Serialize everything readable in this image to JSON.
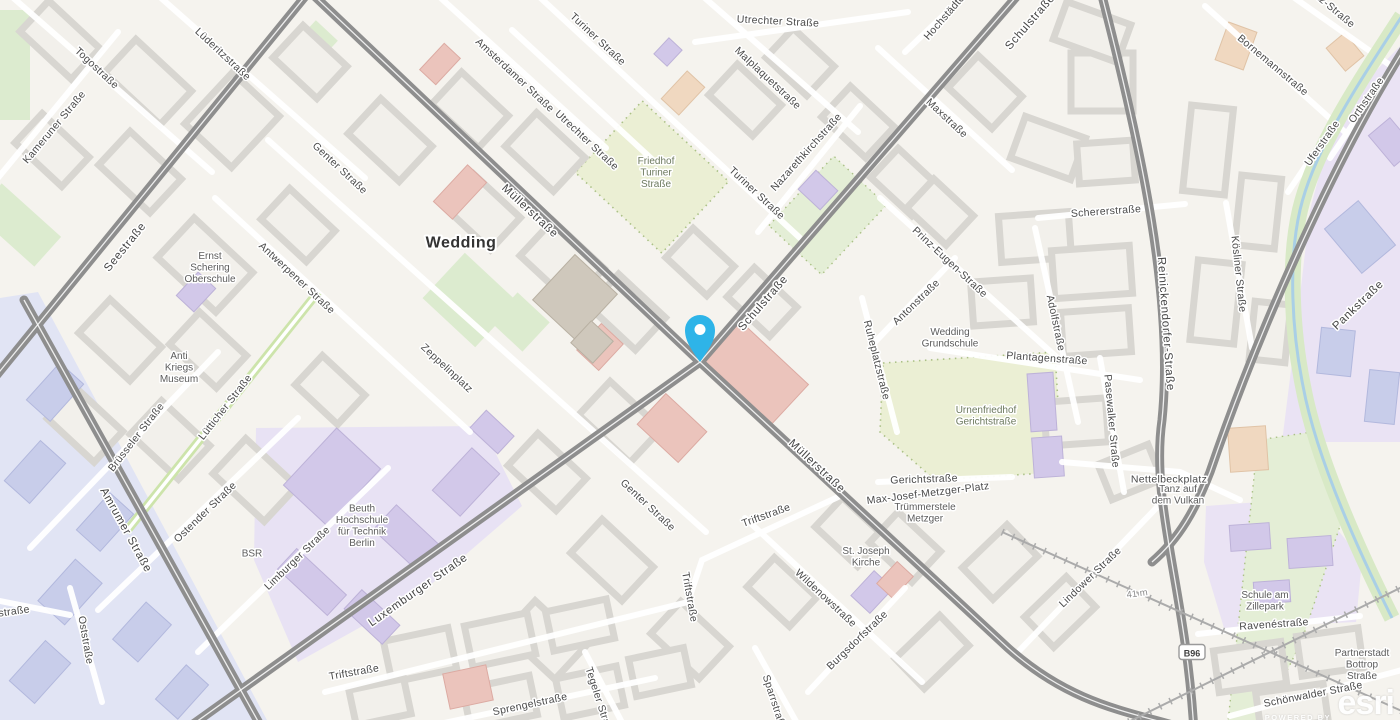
{
  "map": {
    "city_label": "Wedding",
    "labels": [
      {
        "t": "Togostraße",
        "x": 97,
        "y": 68,
        "r": 43,
        "c": "st"
      },
      {
        "t": "Kameruner Straße",
        "x": 54,
        "y": 127,
        "r": -50,
        "c": "st"
      },
      {
        "t": "Lüderitzstraße",
        "x": 223,
        "y": 54,
        "r": 43,
        "c": "st"
      },
      {
        "t": "Genter Straße",
        "x": 340,
        "y": 168,
        "r": 43,
        "c": "st"
      },
      {
        "t": "Genter Straße",
        "x": 648,
        "y": 505,
        "r": 43,
        "c": "st"
      },
      {
        "t": "Antwerpener Straße",
        "x": 297,
        "y": 278,
        "r": 43,
        "c": "st"
      },
      {
        "t": "Amsterdamer Straße",
        "x": 515,
        "y": 75,
        "r": 43,
        "c": "st"
      },
      {
        "t": "Turiner Straße",
        "x": 598,
        "y": 39,
        "r": 43,
        "c": "st"
      },
      {
        "t": "Turiner Straße",
        "x": 757,
        "y": 193,
        "r": 43,
        "c": "st"
      },
      {
        "t": "Utrechter Straße",
        "x": 587,
        "y": 140,
        "r": 43,
        "c": "st"
      },
      {
        "t": "Utrechter Straße",
        "x": 778,
        "y": 21,
        "r": 3,
        "c": "st"
      },
      {
        "t": "Malplaquetstraße",
        "x": 768,
        "y": 78,
        "r": 43,
        "c": "st"
      },
      {
        "t": "Nazarethkirchstraße",
        "x": 806,
        "y": 152,
        "r": -48,
        "c": "st"
      },
      {
        "t": "Hochstädter Str.",
        "x": 952,
        "y": 8,
        "r": -49,
        "c": "st"
      },
      {
        "t": "Maxstraße",
        "x": 947,
        "y": 118,
        "r": 43,
        "c": "st"
      },
      {
        "t": "Schulstraße",
        "x": 1030,
        "y": 22,
        "r": -49,
        "c": "stM"
      },
      {
        "t": "Schulstraße",
        "x": 763,
        "y": 303,
        "r": -49,
        "c": "stM"
      },
      {
        "t": "Müllerstraße",
        "x": 530,
        "y": 211,
        "r": 43,
        "c": "stM"
      },
      {
        "t": "Müllerstraße",
        "x": 817,
        "y": 466,
        "r": 43,
        "c": "stM"
      },
      {
        "t": "Seestraße",
        "x": 125,
        "y": 247,
        "r": -51,
        "c": "stM"
      },
      {
        "t": "Luxemburger Straße",
        "x": 418,
        "y": 590,
        "r": -35,
        "c": "stM"
      },
      {
        "t": "Amrumer Straße",
        "x": 126,
        "y": 530,
        "r": 61,
        "c": "stM"
      },
      {
        "t": "Brüsseler Straße",
        "x": 136,
        "y": 437,
        "r": -52,
        "c": "st"
      },
      {
        "t": "Lütticher Straße",
        "x": 225,
        "y": 407,
        "r": -52,
        "c": "st"
      },
      {
        "t": "Ostender Straße",
        "x": 205,
        "y": 512,
        "r": -44,
        "c": "st"
      },
      {
        "t": "Limburger Straße",
        "x": 297,
        "y": 558,
        "r": -44,
        "c": "st"
      },
      {
        "t": "Oststraße",
        "x": 86,
        "y": 640,
        "r": 80,
        "c": "st"
      },
      {
        "t": "straße",
        "x": 14,
        "y": 611,
        "r": -8,
        "c": "st"
      },
      {
        "t": "Zeppelinplatz",
        "x": 447,
        "y": 368,
        "r": 43,
        "c": "st"
      },
      {
        "t": "Triftstraße",
        "x": 354,
        "y": 672,
        "r": -10,
        "c": "st"
      },
      {
        "t": "Triftstraße",
        "x": 690,
        "y": 597,
        "r": 80,
        "c": "st"
      },
      {
        "t": "Triftstraße",
        "x": 766,
        "y": 515,
        "r": -20,
        "c": "st"
      },
      {
        "t": "Sprengelstraße",
        "x": 530,
        "y": 704,
        "r": -12,
        "c": "st"
      },
      {
        "t": "Tegeler Straße",
        "x": 600,
        "y": 702,
        "r": 72,
        "c": "st"
      },
      {
        "t": "Sparrstraße",
        "x": 775,
        "y": 703,
        "r": 72,
        "c": "st"
      },
      {
        "t": "Wildenowstraße",
        "x": 826,
        "y": 598,
        "r": 43,
        "c": "st"
      },
      {
        "t": "Burgsdorfstraße",
        "x": 857,
        "y": 640,
        "r": -44,
        "c": "st"
      },
      {
        "t": "Gerichtstraße",
        "x": 924,
        "y": 479,
        "r": -2,
        "c": "st"
      },
      {
        "t": "Max-Josef-Metzger-Platz",
        "x": 928,
        "y": 493,
        "r": -7,
        "c": "st"
      },
      {
        "t": "Plantagenstraße",
        "x": 1047,
        "y": 358,
        "r": 4,
        "c": "st"
      },
      {
        "t": "Antonstraße",
        "x": 916,
        "y": 302,
        "r": -44,
        "c": "st"
      },
      {
        "t": "Prinz-Eugen-Straße",
        "x": 950,
        "y": 262,
        "r": 43,
        "c": "st"
      },
      {
        "t": "Adolfstraße",
        "x": 1056,
        "y": 323,
        "r": 78,
        "c": "st"
      },
      {
        "t": "Ruheplatzstraße",
        "x": 877,
        "y": 360,
        "r": 76,
        "c": "st"
      },
      {
        "t": "Pasewalker Straße",
        "x": 1112,
        "y": 421,
        "r": 85,
        "c": "st"
      },
      {
        "t": "Schererstraße",
        "x": 1106,
        "y": 211,
        "r": -4,
        "c": "st"
      },
      {
        "t": "Lindower Straße",
        "x": 1090,
        "y": 577,
        "r": -44,
        "c": "st"
      },
      {
        "t": "Reinickendorfer-Straße",
        "x": 1166,
        "y": 324,
        "r": 86,
        "c": "stM"
      },
      {
        "t": "Kösliner Straße",
        "x": 1239,
        "y": 274,
        "r": 84,
        "c": "st"
      },
      {
        "t": "Pankstraße",
        "x": 1358,
        "y": 305,
        "r": -44,
        "c": "stM"
      },
      {
        "t": "Orthstraße",
        "x": 1366,
        "y": 100,
        "r": -55,
        "c": "st"
      },
      {
        "t": "Uferstraße",
        "x": 1322,
        "y": 143,
        "r": -55,
        "c": "st"
      },
      {
        "t": "Bornemannstraße",
        "x": 1273,
        "y": 65,
        "r": 40,
        "c": "st"
      },
      {
        "t": "itz-Straße",
        "x": 1335,
        "y": 10,
        "r": 40,
        "c": "st"
      },
      {
        "t": "Ravenéstraße",
        "x": 1274,
        "y": 624,
        "r": -4,
        "c": "st"
      },
      {
        "t": "Schönwalder Straße",
        "x": 1313,
        "y": 694,
        "r": -11,
        "c": "st"
      },
      {
        "t": "Nettelbeckplatz",
        "x": 1169,
        "y": 479,
        "r": 0,
        "c": "st"
      },
      {
        "t": "Wedding",
        "x": 461,
        "y": 244,
        "r": 0,
        "c": "city"
      },
      {
        "ls": [
          "Ernst",
          "Schering",
          "Oberschule"
        ],
        "x": 210,
        "y": 267,
        "r": 0,
        "c": "poi"
      },
      {
        "ls": [
          "Anti",
          "Kriegs",
          "Museum"
        ],
        "x": 179,
        "y": 367,
        "r": 0,
        "c": "poi"
      },
      {
        "t": "BSR",
        "x": 252,
        "y": 553,
        "r": 0,
        "c": "poi"
      },
      {
        "ls": [
          "Beuth",
          "Hochschule",
          "für Technik",
          "Berlin"
        ],
        "x": 362,
        "y": 525,
        "r": 0,
        "c": "poi"
      },
      {
        "ls": [
          "Wedding",
          "Grundschule"
        ],
        "x": 950,
        "y": 337,
        "r": 0,
        "c": "poi"
      },
      {
        "ls": [
          "St. Joseph",
          "Kirche"
        ],
        "x": 866,
        "y": 556,
        "r": 0,
        "c": "poi"
      },
      {
        "ls": [
          "Trümmerstele",
          "Metzger"
        ],
        "x": 925,
        "y": 512,
        "r": 0,
        "c": "poi"
      },
      {
        "ls": [
          "Tanz auf",
          "dem Vulkan"
        ],
        "x": 1178,
        "y": 494,
        "r": 0,
        "c": "poi"
      },
      {
        "ls": [
          "Schule am",
          "Zillepark"
        ],
        "x": 1265,
        "y": 600,
        "r": 0,
        "c": "poi"
      },
      {
        "ls": [
          "Partnerstadt",
          "Bottrop",
          "Straße"
        ],
        "x": 1362,
        "y": 664,
        "r": 0,
        "c": "poi"
      },
      {
        "ls": [
          "Friedhof",
          "Turiner",
          "Straße"
        ],
        "x": 656,
        "y": 172,
        "r": 0,
        "c": "nat"
      },
      {
        "ls": [
          "Urnenfriedhof",
          "Gerichtstraße"
        ],
        "x": 986,
        "y": 415,
        "r": 0,
        "c": "nat"
      },
      {
        "t": "41 m",
        "x": 1137,
        "y": 593,
        "r": -8,
        "c": "elev"
      },
      {
        "t": "B96",
        "x": 1192,
        "y": 653,
        "r": 0,
        "c": "shield"
      }
    ]
  },
  "marker": {
    "x": 700,
    "y": 362,
    "color": "#2eb4e8"
  },
  "attribution": {
    "powered_by": "POWERED BY",
    "brand": "esri"
  },
  "colors": {
    "land": "#f5f3ee",
    "building": "#f2f0eb",
    "building_outline": "#d8d6d1",
    "road_major": "#8e8e8e",
    "street_minor": "#ffffff",
    "park": "#dcebcf",
    "cemetery": "#ebefd4",
    "campus": "#e8e2f4",
    "hospital_zone": "#e1e4f4",
    "water": "#a9cfe6",
    "marker": "#2eb4e8",
    "label": "#4a4a4a",
    "label_poi": "#5c5c5c",
    "label_nature": "#6d7a5f"
  }
}
